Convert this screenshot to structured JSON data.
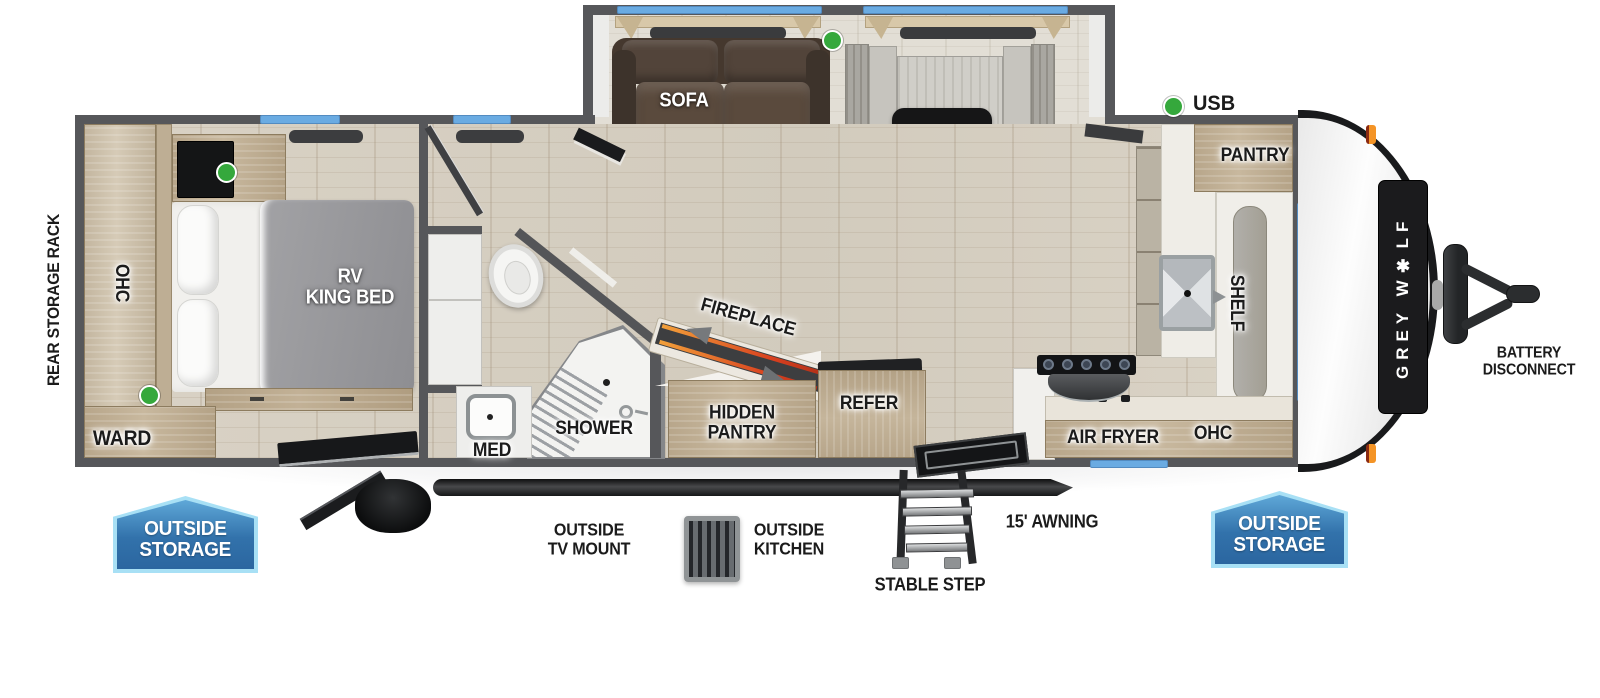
{
  "legend": {
    "usb": "USB"
  },
  "brand": {
    "logo": "GREY W✱LF"
  },
  "exterior_labels": {
    "rear_storage_rack": "REAR STORAGE RACK",
    "outside_storage_line1": "OUTSIDE",
    "outside_storage_line2": "STORAGE",
    "outside_tv_line1": "OUTSIDE",
    "outside_tv_line2": "TV MOUNT",
    "outside_kitchen_line1": "OUTSIDE",
    "outside_kitchen_line2": "KITCHEN",
    "stable_step": "STABLE STEP",
    "awning": "15' AWNING",
    "battery_line1": "BATTERY",
    "battery_line2": "DISCONNECT"
  },
  "bedroom": {
    "ohc": "OHC",
    "bed_line1": "RV",
    "bed_line2": "KING BED",
    "ward": "WARD"
  },
  "bathroom": {
    "med": "MED",
    "shower": "SHOWER"
  },
  "living": {
    "sofa": "SOFA",
    "dinette": "DINETTE",
    "fireplace": "FIREPLACE",
    "hidden_pantry_line1": "HIDDEN",
    "hidden_pantry_line2": "PANTRY",
    "refer": "REFER"
  },
  "kitchen": {
    "pantry": "PANTRY",
    "shelf": "SHELF",
    "air_fryer": "AIR FRYER",
    "ohc": "OHC"
  },
  "colors": {
    "wall": "#56575a",
    "window_blue": "#6aabe2",
    "badge_fill": "#3272ab",
    "badge_border": "#a8e0f5",
    "usb_green": "#35a83c",
    "marker_orange": "#f49426",
    "flame_orange": "#e8711f",
    "wood": "#c8b89e"
  }
}
